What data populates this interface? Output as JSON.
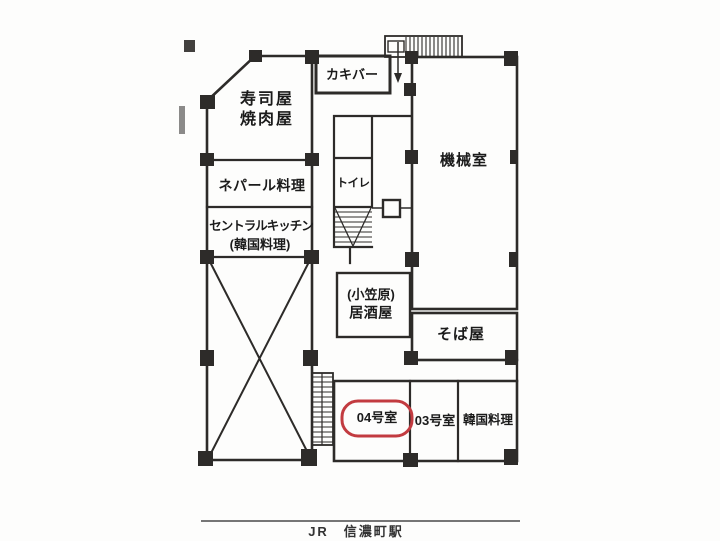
{
  "title": "floor-plan",
  "labels": {
    "sushi_line1": "寿司屋",
    "sushi_line2": "焼肉屋",
    "nepal": "ネパール料理",
    "central_kitchen_line1": "セントラルキッチン",
    "central_kitchen_line2": "(韓国料理)",
    "kaki_bar": "カキバー",
    "toilet": "トイレ",
    "machine_room": "機械室",
    "izakaya_line1": "(小笠原)",
    "izakaya_line2": "居酒屋",
    "soba": "そば屋",
    "room_04": "04号室",
    "room_03": "03号室",
    "korean_restaurant": "韓国料理",
    "station": "JR　信濃町駅"
  },
  "highlighted_room": "04号室",
  "colors": {
    "line": "#2d2b29",
    "highlight": "#c23b40",
    "text": "#1b1b1b"
  }
}
